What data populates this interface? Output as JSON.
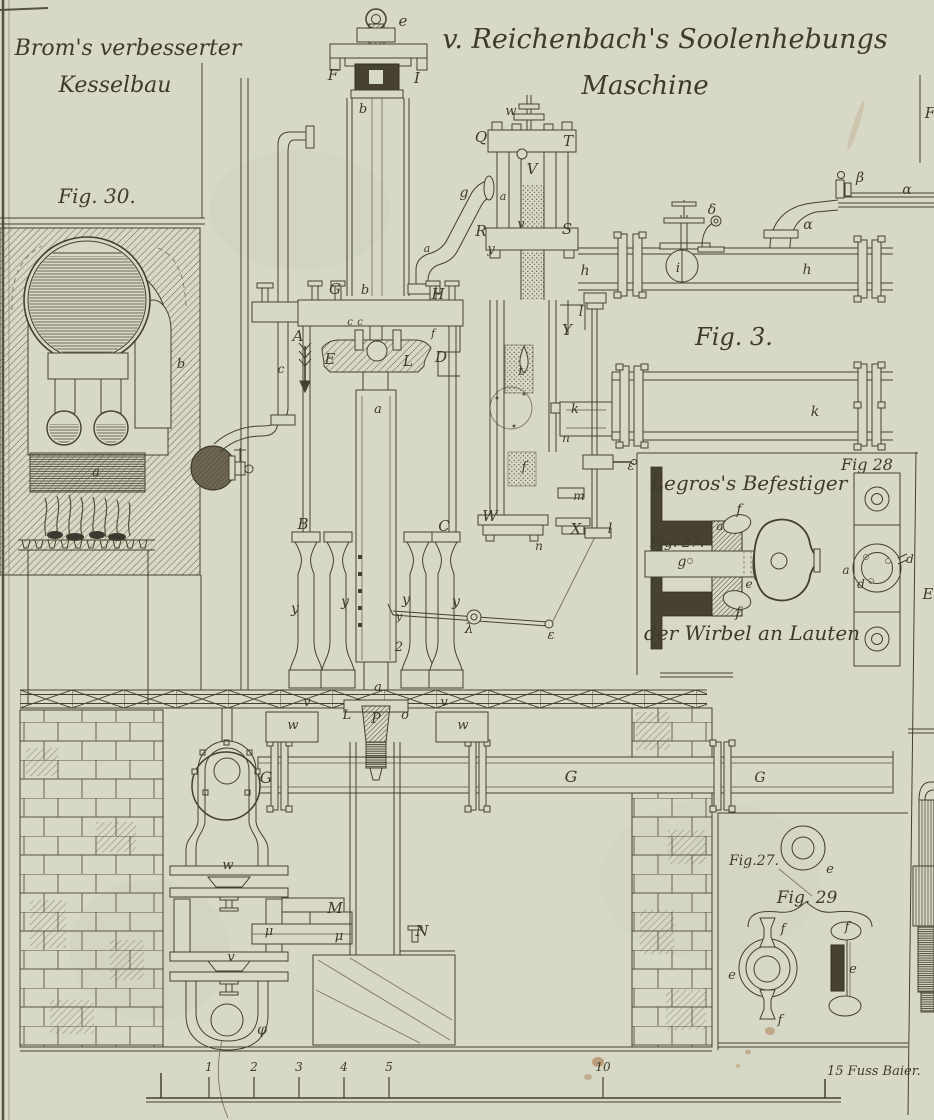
{
  "titles": {
    "top_left_1": "Brom's verbesserter",
    "top_left_2": "Kesselbau",
    "main_1": "v. Reichenbach's Soolenhebungs",
    "main_2": "Maschine"
  },
  "captions": {
    "fig30": "Fig. 30.",
    "fig3": "Fig. 3.",
    "fig28": "Fig 28",
    "fig27_side": "Fig. 27.",
    "legros_title": "Legros's Befestiger",
    "legros_sub": "der Wirbel an Lauten",
    "fig27_b": "Fig.27.",
    "fig29": "Fig. 29"
  },
  "scale": {
    "numbers": [
      {
        "t": "1",
        "x": 209
      },
      {
        "t": "2",
        "x": 254
      },
      {
        "t": "3",
        "x": 299
      },
      {
        "t": "4",
        "x": 344
      },
      {
        "t": "5",
        "x": 389
      },
      {
        "t": "10",
        "x": 603
      }
    ],
    "end_label": "15 Fuss Baier.",
    "x_start": 161,
    "x_end": 825,
    "baseline_y": 1098
  },
  "part_labels": [
    {
      "t": "e",
      "x": 403,
      "y": 26
    },
    {
      "t": "F",
      "x": 333,
      "y": 80
    },
    {
      "t": "I",
      "x": 417,
      "y": 83
    },
    {
      "t": "b",
      "x": 363,
      "y": 113,
      "s": 13
    },
    {
      "t": "w",
      "x": 511,
      "y": 115,
      "s": 13
    },
    {
      "t": "Q",
      "x": 481,
      "y": 142
    },
    {
      "t": "T",
      "x": 568,
      "y": 146
    },
    {
      "t": "V",
      "x": 532,
      "y": 174
    },
    {
      "t": "v",
      "x": 521,
      "y": 228,
      "s": 13
    },
    {
      "t": "R",
      "x": 481,
      "y": 236
    },
    {
      "t": "S",
      "x": 567,
      "y": 234
    },
    {
      "t": "y",
      "x": 491,
      "y": 253,
      "s": 13
    },
    {
      "t": "g",
      "x": 464,
      "y": 197,
      "s": 14
    },
    {
      "t": "a",
      "x": 503,
      "y": 200,
      "s": 11
    },
    {
      "t": "G",
      "x": 335,
      "y": 294
    },
    {
      "t": "b",
      "x": 365,
      "y": 294,
      "s": 13
    },
    {
      "t": "H",
      "x": 438,
      "y": 299
    },
    {
      "t": "a",
      "x": 427,
      "y": 252,
      "s": 11
    },
    {
      "t": "c",
      "x": 350,
      "y": 325,
      "s": 10
    },
    {
      "t": "c",
      "x": 360,
      "y": 325,
      "s": 10
    },
    {
      "t": "A",
      "x": 298,
      "y": 341
    },
    {
      "t": "E",
      "x": 330,
      "y": 364
    },
    {
      "t": "L",
      "x": 408,
      "y": 366
    },
    {
      "t": "D",
      "x": 441,
      "y": 362
    },
    {
      "t": "f",
      "x": 433,
      "y": 337,
      "s": 11
    },
    {
      "t": "c",
      "x": 281,
      "y": 373,
      "s": 12
    },
    {
      "t": "a",
      "x": 96,
      "y": 476,
      "s": 13
    },
    {
      "t": "b",
      "x": 181,
      "y": 368,
      "s": 13
    },
    {
      "t": "a",
      "x": 378,
      "y": 413,
      "s": 13
    },
    {
      "t": "B",
      "x": 303,
      "y": 529
    },
    {
      "t": "C",
      "x": 444,
      "y": 531
    },
    {
      "t": "y",
      "x": 295,
      "y": 613,
      "s": 14
    },
    {
      "t": "y",
      "x": 345,
      "y": 606,
      "s": 14
    },
    {
      "t": "y",
      "x": 406,
      "y": 604,
      "s": 14
    },
    {
      "t": "y",
      "x": 456,
      "y": 606,
      "s": 14
    },
    {
      "t": "y",
      "x": 399,
      "y": 620,
      "s": 11
    },
    {
      "t": "2",
      "x": 399,
      "y": 651,
      "s": 13
    },
    {
      "t": "λ",
      "x": 469,
      "y": 633,
      "s": 14
    },
    {
      "t": "ε",
      "x": 551,
      "y": 639,
      "s": 13
    },
    {
      "t": "Y",
      "x": 567,
      "y": 335
    },
    {
      "t": "t",
      "x": 521,
      "y": 375,
      "s": 13
    },
    {
      "t": "k",
      "x": 575,
      "y": 413,
      "s": 13
    },
    {
      "t": "n",
      "x": 566,
      "y": 442,
      "s": 12
    },
    {
      "t": "f",
      "x": 524,
      "y": 471,
      "s": 13
    },
    {
      "t": "W",
      "x": 490,
      "y": 521
    },
    {
      "t": "m",
      "x": 579,
      "y": 500,
      "s": 12
    },
    {
      "t": "X",
      "x": 576,
      "y": 534
    },
    {
      "t": "n",
      "x": 539,
      "y": 550,
      "s": 12
    },
    {
      "t": "l",
      "x": 581,
      "y": 316,
      "s": 14
    },
    {
      "t": "l",
      "x": 610,
      "y": 533,
      "s": 14
    },
    {
      "t": "ε",
      "x": 631,
      "y": 470,
      "s": 13
    },
    {
      "t": "h",
      "x": 585,
      "y": 275,
      "s": 14
    },
    {
      "t": "h",
      "x": 807,
      "y": 274,
      "s": 14
    },
    {
      "t": "i",
      "x": 678,
      "y": 272,
      "s": 13
    },
    {
      "t": "δ",
      "x": 712,
      "y": 214,
      "s": 14
    },
    {
      "t": "α",
      "x": 808,
      "y": 229,
      "s": 14
    },
    {
      "t": "α",
      "x": 907,
      "y": 194,
      "s": 14
    },
    {
      "t": "β",
      "x": 860,
      "y": 182,
      "s": 14
    },
    {
      "t": "k",
      "x": 815,
      "y": 416,
      "s": 14
    },
    {
      "t": "F",
      "x": 930,
      "y": 118
    },
    {
      "t": "E",
      "x": 928,
      "y": 599
    },
    {
      "t": "v",
      "x": 307,
      "y": 706,
      "s": 13
    },
    {
      "t": "a",
      "x": 378,
      "y": 691,
      "s": 13
    },
    {
      "t": "v",
      "x": 444,
      "y": 706,
      "s": 13
    },
    {
      "t": "L",
      "x": 347,
      "y": 719,
      "s": 13
    },
    {
      "t": "P",
      "x": 376,
      "y": 723,
      "s": 14
    },
    {
      "t": "o",
      "x": 405,
      "y": 719,
      "s": 13
    },
    {
      "t": "w",
      "x": 293,
      "y": 729,
      "s": 13
    },
    {
      "t": "w",
      "x": 463,
      "y": 729,
      "s": 13
    },
    {
      "t": "G",
      "x": 266,
      "y": 783,
      "s": 16
    },
    {
      "t": "G",
      "x": 571,
      "y": 782,
      "s": 16
    },
    {
      "t": "G",
      "x": 760,
      "y": 782,
      "s": 14
    },
    {
      "t": "w",
      "x": 228,
      "y": 869,
      "s": 13
    },
    {
      "t": "M",
      "x": 335,
      "y": 913
    },
    {
      "t": "μ",
      "x": 269,
      "y": 935,
      "s": 13
    },
    {
      "t": "μ",
      "x": 339,
      "y": 940,
      "s": 13
    },
    {
      "t": "v",
      "x": 231,
      "y": 961,
      "s": 13
    },
    {
      "t": "N",
      "x": 422,
      "y": 936
    },
    {
      "t": "φ",
      "x": 262,
      "y": 1034,
      "s": 14
    },
    {
      "t": "f",
      "x": 739,
      "y": 514,
      "s": 14
    },
    {
      "t": "f",
      "x": 738,
      "y": 617,
      "s": 14
    },
    {
      "t": "a",
      "x": 720,
      "y": 530,
      "s": 12
    },
    {
      "t": "e",
      "x": 749,
      "y": 588,
      "s": 12
    },
    {
      "t": "g",
      "x": 682,
      "y": 566,
      "s": 14
    },
    {
      "t": "a",
      "x": 846,
      "y": 574,
      "s": 12
    },
    {
      "t": "d",
      "x": 861,
      "y": 588,
      "s": 12
    },
    {
      "t": "d",
      "x": 910,
      "y": 563,
      "s": 12
    },
    {
      "t": "e",
      "x": 830,
      "y": 873,
      "s": 13
    },
    {
      "t": "f",
      "x": 783,
      "y": 933,
      "s": 13
    },
    {
      "t": "f",
      "x": 780,
      "y": 1024,
      "s": 13
    },
    {
      "t": "e",
      "x": 732,
      "y": 979,
      "s": 13
    },
    {
      "t": "f",
      "x": 847,
      "y": 931,
      "s": 13
    },
    {
      "t": "e",
      "x": 853,
      "y": 973,
      "s": 13
    }
  ],
  "colors": {
    "paper": "#d7d8c6",
    "ink": "#45402e",
    "hatch": "#6a6450",
    "stain": "#a3703f"
  }
}
